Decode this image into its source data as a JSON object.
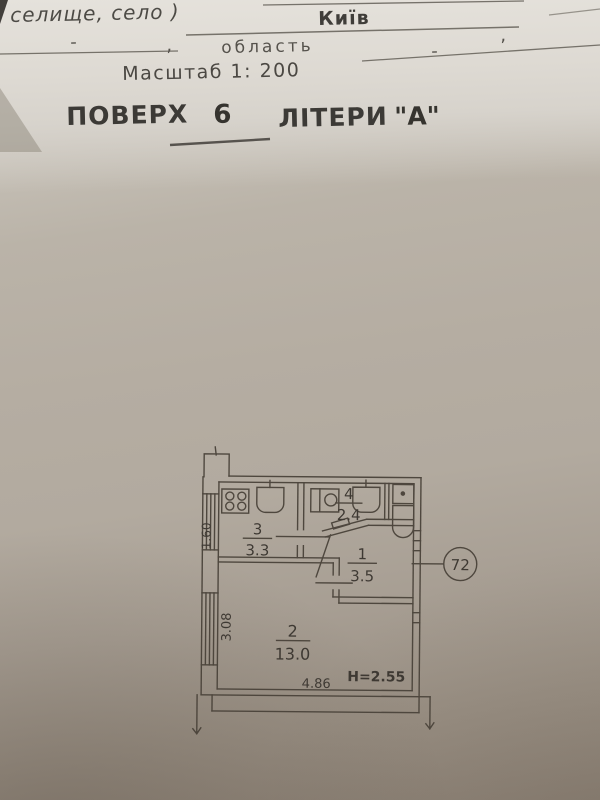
{
  "header": {
    "settlement_label": "селище, село )",
    "settlement_value": "Київ",
    "dash_left": "-",
    "comma_left": ",",
    "oblast_label": "область",
    "dash_right": "-",
    "comma_right": ",",
    "scale": "Масштаб 1: 200",
    "floor_label": "ПОВЕРХ",
    "floor_value": "6",
    "liter_label": "ЛІТЕРИ",
    "liter_value": "\"А\""
  },
  "plan": {
    "rooms": [
      {
        "number": "1",
        "area": "3.5"
      },
      {
        "number": "2",
        "area": "13.0"
      },
      {
        "number": "3",
        "area": "3.3"
      },
      {
        "number": "4",
        "area": "2.4"
      }
    ],
    "dims": {
      "kitchen_window": "1.60",
      "living_depth": "3.08",
      "living_width": "4.86",
      "ceiling_height": "H=2.55"
    },
    "apartment_number": "72",
    "fixture_icons": [
      "stove-icon",
      "kitchen-sink-icon",
      "washbasin-icon",
      "bath-sink-icon",
      "toilet-icon"
    ]
  },
  "colors": {
    "paper_light": "#dcd8d1",
    "paper_mid": "#b5ada2",
    "paper_dark": "#8e8478",
    "ink": "#46443f",
    "plan_line": "#4e473e"
  }
}
